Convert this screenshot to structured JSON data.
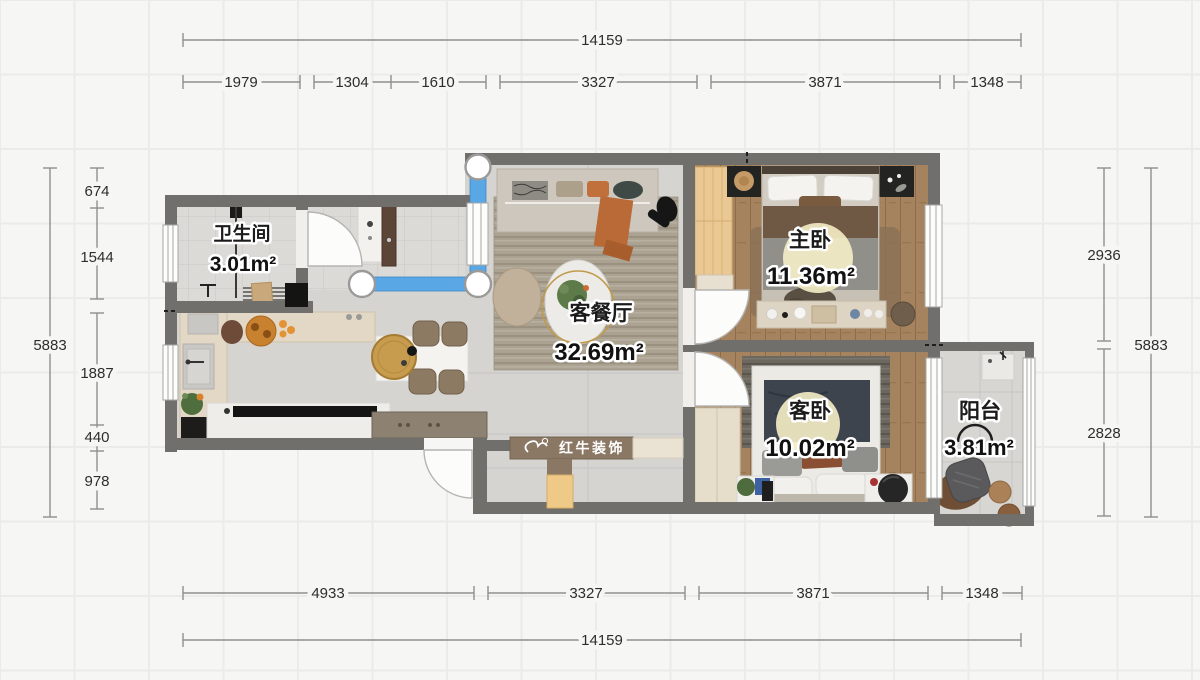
{
  "rooms": [
    {
      "id": "bathroom",
      "name": "卫生间",
      "area": "3.01m²"
    },
    {
      "id": "living-dining",
      "name": "客餐厅",
      "area": "32.69m²"
    },
    {
      "id": "master-bedroom",
      "name": "主卧",
      "area": "11.36m²"
    },
    {
      "id": "second-bedroom",
      "name": "客卧",
      "area": "10.02m²"
    },
    {
      "id": "balcony",
      "name": "阳台",
      "area": "3.81m²"
    }
  ],
  "dimensions": {
    "top": {
      "total": "14159",
      "segments": [
        "1979",
        "1304",
        "1610",
        "3327",
        "3871",
        "1348"
      ]
    },
    "bottom": {
      "total": "14159",
      "segments": [
        "4933",
        "3327",
        "3871",
        "1348"
      ]
    },
    "left": {
      "total": "5883",
      "segments": [
        "674",
        "1544",
        "1887",
        "440",
        "978"
      ]
    },
    "right": {
      "total": "5883",
      "segments": [
        "2936",
        "2828"
      ]
    }
  },
  "watermark": {
    "brand": "红牛装饰"
  },
  "colors": {
    "wall_gray": "#706f6c",
    "new_wall_blue": "#5aa7e6",
    "wood_floor": "#a6835f",
    "concrete_floor": "#d5d4d1",
    "dimension_text": "#2d2d2d"
  }
}
